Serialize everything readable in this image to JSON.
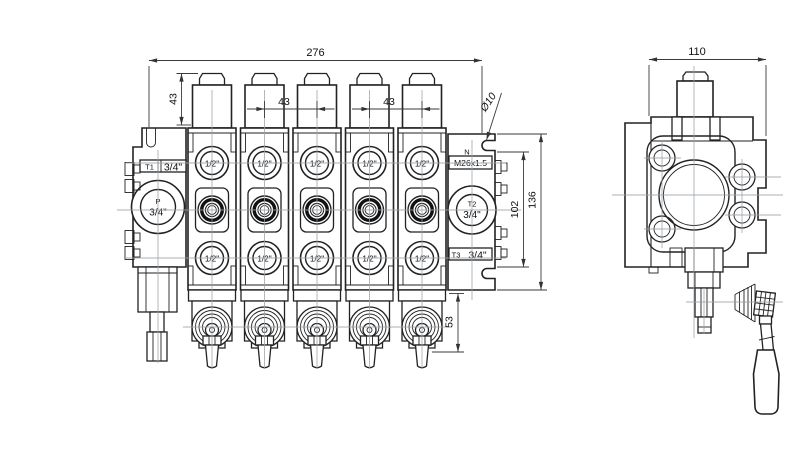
{
  "drawing": {
    "front_view": {
      "dim_overall_width": "276",
      "dim_cap_height": "43",
      "dim_section_spacing_left": "43",
      "dim_section_spacing_right": "43",
      "dim_mount_hole": "Ø10",
      "dim_port_span": "102",
      "dim_plate_height": "136",
      "dim_lever_projection": "53",
      "ports": {
        "t1_label": "T1",
        "t1_size": "3/4\"",
        "p_label": "P",
        "p_size": "3/4\"",
        "n_label": "N",
        "gauge_thread": "M26x1.5",
        "t2_label": "T2",
        "t2_size": "3/4\"",
        "t3_label": "T3",
        "t3_size": "3/4\"",
        "work_port_size": "1/2\""
      }
    },
    "side_view": {
      "dim_width": "110"
    }
  }
}
